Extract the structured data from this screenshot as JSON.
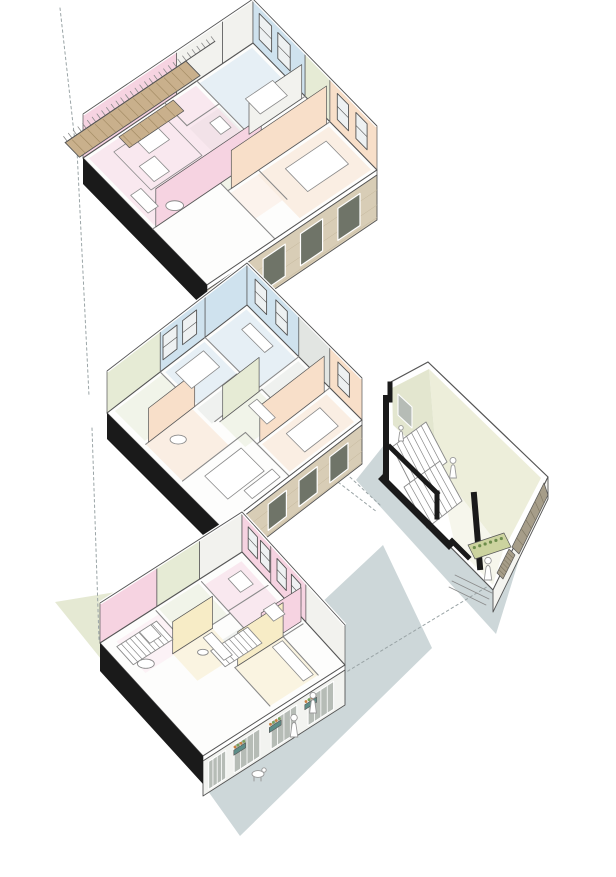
{
  "diagram": {
    "kind": "exploded-axonometric-housing-diagram",
    "canvas": {
      "w": 616,
      "h": 877
    },
    "labels": {}
  },
  "palette": {
    "blue": "#cfe2ee",
    "pink": "#f6d3e1",
    "pinkLight": "#fbe7ef",
    "peach": "#f8dfc9",
    "peachLight": "#fbeadd",
    "sage": "#e6ebd5",
    "grey": "#e2e5e2",
    "yellow": "#f7ecc6",
    "white2": "#f2f2ee",
    "wood": "#c9b08c",
    "woodLine": "#a58d66",
    "brick": "#d8cdb6",
    "brickLine": "#c4b79c",
    "black": "#1a1a1a",
    "line": "#555555",
    "innerLine": "#8a8a8a",
    "groundGrey": "#cdd7d9",
    "groundSage": "#e5e9d3",
    "cream": "#edeeda",
    "cream2": "#e3e6cf",
    "floorCream": "#f6f6ec",
    "timber": "#a69d89",
    "timberLine": "#7e7662",
    "planterGreen": "#ccd39f",
    "leafDark": "#6d8d4b",
    "teal": "#5d8d88",
    "flower": "#c9803f",
    "leaf": "#79a058",
    "glass": "#eef1f2",
    "winDark": "#6f7468",
    "opening": "#b6bcb6",
    "figure": "#ffffff",
    "figureLine": "#999999",
    "dash": "#9aa4a6"
  },
  "shadows": [
    {
      "name": "ground-shadow-sage",
      "color": "groundSage",
      "points": [
        [
          55,
          602
        ],
        [
          152,
          586
        ],
        [
          232,
          654
        ],
        [
          126,
          690
        ]
      ]
    },
    {
      "name": "ground-shadow-grey-main",
      "color": "groundGrey",
      "points": [
        [
          383,
          545
        ],
        [
          432,
          648
        ],
        [
          240,
          836
        ],
        [
          173,
          742
        ]
      ]
    },
    {
      "name": "ground-shadow-grey-staircore",
      "color": "groundGrey",
      "points": [
        [
          420,
          400
        ],
        [
          536,
          505
        ],
        [
          496,
          634
        ],
        [
          356,
          480
        ]
      ]
    }
  ],
  "dashed_lines": [
    {
      "name": "projection-line-top",
      "p": [
        [
          60,
          8
        ],
        [
          75,
          142
        ]
      ]
    },
    {
      "name": "projection-line-upper-to-middle",
      "p": [
        [
          77,
          150
        ],
        [
          89,
          396
        ]
      ]
    },
    {
      "name": "projection-line-middle-to-ground",
      "p": [
        [
          92,
          428
        ],
        [
          99,
          640
        ]
      ]
    },
    {
      "name": "projection-line-staircore-to-ground-floor",
      "p": [
        [
          343,
          674
        ],
        [
          490,
          585
        ]
      ]
    },
    {
      "name": "projection-line-middle-to-staircore-a",
      "p": [
        [
          338,
          466
        ],
        [
          380,
          505
        ]
      ]
    },
    {
      "name": "projection-line-middle-to-staircore-b",
      "p": [
        [
          334,
          479
        ],
        [
          377,
          512
        ]
      ]
    }
  ],
  "floors": [
    {
      "name": "upper-floor-plan",
      "n": [
        253,
        43
      ],
      "a": [
        124,
        127
      ],
      "b": [
        -170,
        115
      ],
      "wallH": 44,
      "facadeH": 50,
      "blackH": 26,
      "facadeType": "brick",
      "bandsNE": [
        [
          0,
          0.42,
          "blue"
        ],
        [
          0.42,
          0.62,
          "sage"
        ],
        [
          0.62,
          1,
          "peach"
        ]
      ],
      "bandsNW": [
        [
          0,
          0.18,
          "white2"
        ],
        [
          0.18,
          0.45,
          "white2"
        ],
        [
          0.45,
          1,
          "pink"
        ]
      ],
      "winNE": [
        [
          0.05,
          0.1
        ],
        [
          0.2,
          0.1
        ],
        [
          0.68,
          0.09
        ],
        [
          0.83,
          0.09
        ]
      ],
      "winNW": [],
      "tints": [
        [
          0.02,
          0.02,
          0.4,
          0.31,
          "blue"
        ],
        [
          0.44,
          0.02,
          0.18,
          0.3,
          "sage"
        ],
        [
          0.64,
          0.02,
          0.34,
          0.42,
          "peach"
        ],
        [
          0.2,
          0.34,
          0.22,
          0.18,
          "grey"
        ],
        [
          0.44,
          0.34,
          0.18,
          0.26,
          "sage"
        ],
        [
          0.02,
          0.35,
          0.53,
          0.63,
          "pink"
        ],
        [
          0.64,
          0.44,
          0.2,
          0.16,
          "peachLight"
        ]
      ],
      "walls": [
        [
          0.42,
          0,
          0.42,
          0.33
        ],
        [
          0.62,
          0,
          0.62,
          0.6
        ],
        [
          0,
          0.33,
          0.42,
          0.33
        ],
        [
          0.18,
          0.33,
          0.18,
          0.52
        ],
        [
          0.42,
          0.33,
          0.42,
          0.52
        ],
        [
          0,
          0.52,
          0.18,
          0.52
        ],
        [
          0.44,
          0.6,
          1,
          0.6
        ],
        [
          0.56,
          0.35,
          0.56,
          1
        ],
        [
          0.62,
          0.42,
          0.85,
          0.42
        ]
      ],
      "faces": [
        [
          0.56,
          0.36,
          0.56,
          0.98,
          38,
          "pink"
        ],
        [
          0.62,
          0.02,
          0.62,
          0.58,
          38,
          "peach"
        ],
        [
          0.42,
          0.02,
          0.42,
          0.33,
          34,
          "white2"
        ]
      ],
      "furnRects": [
        [
          0.24,
          0.06,
          0.12,
          0.16
        ],
        [
          0.7,
          0.08,
          0.18,
          0.24
        ],
        [
          0.1,
          0.63,
          0.09,
          0.12
        ],
        [
          0.22,
          0.74,
          0.12,
          0.09
        ],
        [
          0.33,
          0.9,
          0.14,
          0.06
        ],
        [
          0.24,
          0.37,
          0.09,
          0.06
        ]
      ],
      "rugRects": [
        [
          0.07,
          0.57,
          0.3,
          0.3
        ]
      ],
      "circles": [
        [
          0.52,
          0.84,
          0.05
        ]
      ],
      "balcony": {
        "u0": -0.13,
        "u1": -0.015,
        "v0": 0.3,
        "v1": 1.01,
        "railV0": 0.13
      },
      "blinds": {
        "u0": 0.015,
        "u1": 0.1,
        "v0": 0.48,
        "v1": 0.8
      },
      "stairs": []
    },
    {
      "name": "middle-floor-plan",
      "n": [
        247,
        305
      ],
      "a": [
        115,
        115
      ],
      "b": [
        -140,
        108
      ],
      "wallH": 42,
      "facadeH": 44,
      "blackH": 26,
      "facadeType": "brick",
      "bandsNE": [
        [
          0,
          0.45,
          "blue"
        ],
        [
          0.45,
          0.72,
          "grey"
        ],
        [
          0.72,
          1,
          "peach"
        ]
      ],
      "bandsNW": [
        [
          0,
          0.3,
          "blue"
        ],
        [
          0.3,
          0.62,
          "blue"
        ],
        [
          0.62,
          1,
          "sage"
        ]
      ],
      "winNE": [
        [
          0.07,
          0.1
        ],
        [
          0.25,
          0.1
        ],
        [
          0.79,
          0.1
        ]
      ],
      "winNW": [
        [
          0.36,
          0.1
        ],
        [
          0.5,
          0.1
        ]
      ],
      "tints": [
        [
          0.02,
          0.02,
          0.43,
          0.28,
          "blue"
        ],
        [
          0.47,
          0.02,
          0.23,
          0.26,
          "grey"
        ],
        [
          0.74,
          0.04,
          0.24,
          0.46,
          "peach"
        ],
        [
          0.02,
          0.32,
          0.28,
          0.28,
          "blue"
        ],
        [
          0.32,
          0.34,
          0.13,
          0.28,
          "grey"
        ],
        [
          0.47,
          0.3,
          0.22,
          0.28,
          "sage"
        ],
        [
          0.02,
          0.62,
          0.26,
          0.34,
          "sage"
        ],
        [
          0.3,
          0.64,
          0.32,
          0.33,
          "peach"
        ]
      ],
      "walls": [
        [
          0.45,
          0,
          0.45,
          0.3
        ],
        [
          0.72,
          0,
          0.72,
          0.52
        ],
        [
          0,
          0.3,
          0.45,
          0.3
        ],
        [
          0.3,
          0.32,
          0.3,
          0.62
        ],
        [
          0.47,
          0.28,
          0.7,
          0.28
        ],
        [
          0.47,
          0.28,
          0.47,
          0.58
        ],
        [
          0,
          0.62,
          0.3,
          0.62
        ],
        [
          0.3,
          0.62,
          0.3,
          0.97
        ],
        [
          0.62,
          0.52,
          1,
          0.52
        ],
        [
          0.62,
          0.52,
          0.62,
          0.97
        ],
        [
          0.45,
          0.3,
          0.45,
          0.6
        ]
      ],
      "faces": [
        [
          0.72,
          0.04,
          0.72,
          0.5,
          36,
          "peach"
        ],
        [
          0.47,
          0.3,
          0.47,
          0.56,
          34,
          "sage"
        ],
        [
          0.3,
          0.62,
          0.3,
          0.95,
          34,
          "peach"
        ]
      ],
      "furnRects": [
        [
          0.78,
          0.12,
          0.16,
          0.24
        ],
        [
          0.06,
          0.36,
          0.14,
          0.2
        ],
        [
          0.1,
          0.06,
          0.2,
          0.06
        ],
        [
          0.68,
          0.6,
          0.2,
          0.26
        ],
        [
          0.9,
          0.56,
          0.07,
          0.2
        ],
        [
          0.5,
          0.34,
          0.16,
          0.06
        ]
      ],
      "rugRects": [],
      "circles": [
        [
          0.4,
          0.82,
          0.05
        ]
      ],
      "balcony": null,
      "blinds": null,
      "stairs": []
    },
    {
      "name": "ground-floor-plan",
      "n": [
        242,
        552
      ],
      "a": [
        103,
        113
      ],
      "b": [
        -142,
        91
      ],
      "wallH": 40,
      "facadeH": 40,
      "blackH": 28,
      "facadeType": "street",
      "bandsNE": [
        [
          0,
          0.28,
          "pink"
        ],
        [
          0.28,
          0.62,
          "pink"
        ],
        [
          0.62,
          1,
          "white2"
        ]
      ],
      "bandsNW": [
        [
          0,
          0.3,
          "white2"
        ],
        [
          0.3,
          0.6,
          "sage"
        ],
        [
          0.6,
          1,
          "pink"
        ]
      ],
      "winNE": [
        [
          0.06,
          0.09
        ],
        [
          0.18,
          0.09
        ],
        [
          0.34,
          0.09
        ],
        [
          0.48,
          0.09
        ]
      ],
      "winNW": [],
      "tints": [
        [
          0.05,
          0.04,
          0.5,
          0.26,
          "pink"
        ],
        [
          0.05,
          0.62,
          0.28,
          0.3,
          "pinkLight"
        ],
        [
          0.62,
          0.16,
          0.34,
          0.34,
          "yellow"
        ],
        [
          0.32,
          0.44,
          0.24,
          0.28,
          "yellow"
        ],
        [
          0.42,
          0.3,
          0.16,
          0.14,
          "grey"
        ],
        [
          0.02,
          0.32,
          0.28,
          0.28,
          "sage"
        ]
      ],
      "walls": [
        [
          0.28,
          0.02,
          0.28,
          0.3
        ],
        [
          0.62,
          0.02,
          0.62,
          0.5
        ],
        [
          0.02,
          0.3,
          0.56,
          0.3
        ],
        [
          0.3,
          0.3,
          0.3,
          0.62
        ],
        [
          0.56,
          0.3,
          0.56,
          0.52
        ],
        [
          0.62,
          0.16,
          0.96,
          0.16
        ],
        [
          0.32,
          0.44,
          0.32,
          0.72
        ],
        [
          0.02,
          0.62,
          0.3,
          0.62
        ],
        [
          0.62,
          0.5,
          0.96,
          0.5
        ]
      ],
      "faces": [
        [
          0.6,
          0.02,
          0.6,
          0.3,
          34,
          "pink"
        ],
        [
          0.62,
          0.16,
          0.62,
          0.48,
          34,
          "yellow"
        ],
        [
          0.32,
          0.44,
          0.32,
          0.72,
          32,
          "yellow"
        ]
      ],
      "furnRects": [
        [
          0.64,
          0.18,
          0.3,
          0.07
        ],
        [
          0.34,
          0.46,
          0.2,
          0.06
        ],
        [
          0.1,
          0.08,
          0.12,
          0.09
        ],
        [
          0.4,
          0.06,
          0.1,
          0.08
        ],
        [
          0.08,
          0.7,
          0.1,
          0.08
        ]
      ],
      "rugRects": [],
      "circles": [
        [
          0.28,
          0.88,
          0.055
        ],
        [
          0.42,
          0.58,
          0.035
        ]
      ],
      "balcony": null,
      "blinds": null,
      "stairs": [
        {
          "u0": 0.08,
          "v0": 0.66,
          "u1": 0.24,
          "v1": 0.94,
          "n": 9
        },
        {
          "u0": 0.44,
          "v0": 0.28,
          "u1": 0.58,
          "v1": 0.54,
          "n": 8
        }
      ]
    }
  ],
  "street": {
    "planter_ts": [
      0.2,
      0.45,
      0.7
    ],
    "figures": [
      {
        "name": "pedestrian-figure",
        "x": 294,
        "y": 737,
        "h": 22
      },
      {
        "name": "pedestrian-figure",
        "x": 313,
        "y": 713,
        "h": 20
      }
    ],
    "dog": {
      "name": "dog-figure",
      "x": 258,
      "y": 774
    }
  },
  "stair_core": {
    "name": "stair-core-section",
    "silhouette": [
      [
        428,
        362
      ],
      [
        548,
        477
      ],
      [
        493,
        590
      ],
      [
        383,
        479
      ],
      [
        389,
        383
      ]
    ],
    "wallRight": [
      [
        429,
        369
      ],
      [
        541,
        478
      ],
      [
        503,
        551
      ],
      [
        437,
        466
      ]
    ],
    "wallLeft": [
      [
        429,
        369
      ],
      [
        437,
        466
      ],
      [
        393,
        425
      ],
      [
        392,
        388
      ]
    ],
    "floorStrip": [
      [
        437,
        466
      ],
      [
        503,
        551
      ],
      [
        493,
        585
      ],
      [
        455,
        545
      ]
    ],
    "window": [
      [
        398,
        394
      ],
      [
        412,
        407
      ],
      [
        412,
        428
      ],
      [
        398,
        415
      ]
    ],
    "blackStrokes": [
      {
        "d": [
          [
            386,
            398
          ],
          [
            386,
            477
          ]
        ],
        "w": 6
      },
      {
        "d": [
          [
            383,
            479
          ],
          [
            449,
            545
          ]
        ],
        "w": 7
      },
      {
        "d": [
          [
            390,
            447
          ],
          [
            437,
            493
          ]
        ],
        "w": 5
      },
      {
        "d": [
          [
            437,
            493
          ],
          [
            437,
            517
          ]
        ],
        "w": 5
      },
      {
        "d": [
          [
            474,
            495
          ],
          [
            480,
            567
          ]
        ],
        "w": 6
      },
      {
        "d": [
          [
            452,
            541
          ],
          [
            468,
            557
          ]
        ],
        "w": 5
      },
      {
        "d": [
          [
            390,
            384
          ],
          [
            390,
            400
          ]
        ],
        "w": 5
      }
    ],
    "flights": [
      {
        "q": [
          [
            392,
            447
          ],
          [
            426,
            422
          ],
          [
            447,
            462
          ],
          [
            413,
            488
          ]
        ],
        "n": 7
      },
      {
        "q": [
          [
            404,
            487
          ],
          [
            440,
            461
          ],
          [
            462,
            501
          ],
          [
            427,
            528
          ]
        ],
        "n": 7
      }
    ],
    "facadeBand": [
      [
        548,
        477
      ],
      [
        493,
        590
      ],
      [
        493,
        612
      ],
      [
        548,
        499
      ]
    ],
    "timber": [
      [
        544,
        483
      ],
      [
        512,
        547
      ],
      [
        519,
        554
      ],
      [
        548,
        495
      ]
    ],
    "timber2": [
      [
        509,
        549
      ],
      [
        497,
        573
      ],
      [
        503,
        579
      ],
      [
        515,
        555
      ]
    ],
    "planter": [
      [
        468,
        545
      ],
      [
        504,
        533
      ],
      [
        511,
        547
      ],
      [
        475,
        559
      ]
    ],
    "figures": [
      {
        "name": "stair-figure",
        "x": 453,
        "y": 478,
        "h": 20
      },
      {
        "name": "entrance-figure",
        "x": 488,
        "y": 580,
        "h": 22
      },
      {
        "name": "stair-figure",
        "x": 401,
        "y": 441,
        "h": 15
      }
    ],
    "thresholdLines": [
      [
        [
          455,
          575
        ],
        [
          492,
          593
        ]
      ],
      [
        [
          452,
          581
        ],
        [
          489,
          599
        ]
      ],
      [
        [
          449,
          587
        ],
        [
          486,
          605
        ]
      ]
    ]
  }
}
